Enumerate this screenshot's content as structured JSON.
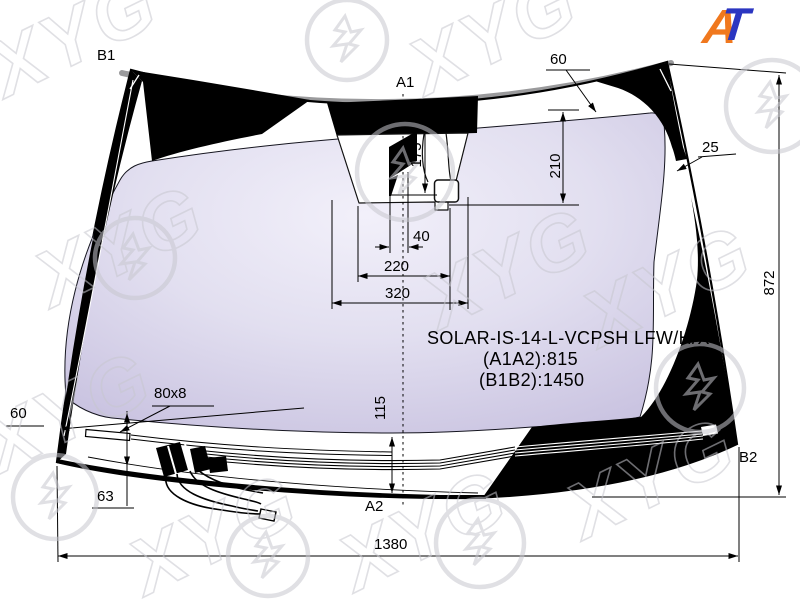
{
  "watermark": {
    "text": "XYG"
  },
  "logo": {
    "a": "A",
    "t": "T"
  },
  "points": {
    "b1": "B1",
    "a1": "A1",
    "a2": "A2",
    "b2": "B2"
  },
  "dims": {
    "top_offset": "60",
    "sensor_total_height": "210",
    "sensor_height": "175",
    "camera_width": "40",
    "bracket_width": "220",
    "frit_width": "320",
    "right_margin": "25",
    "glass_height": "872",
    "bottom_width": "1380",
    "lower_band_height": "115",
    "pad_size": "80x8",
    "left_margin": "60",
    "pad_offset": "63"
  },
  "part": {
    "code": "SOLAR-IS-14-L-VCPSH LFW/H/X",
    "a1a2": "(A1A2):815",
    "b1b2": "(B1B2):1450"
  },
  "colors": {
    "glass_center": "#f1eff9",
    "glass_edge": "#c3bcdc",
    "frit": "#000000",
    "molding": "#9a9a9c",
    "watermark": "#c6c6ce",
    "logo_a": "#f0781e",
    "logo_t": "#2b36c1"
  }
}
